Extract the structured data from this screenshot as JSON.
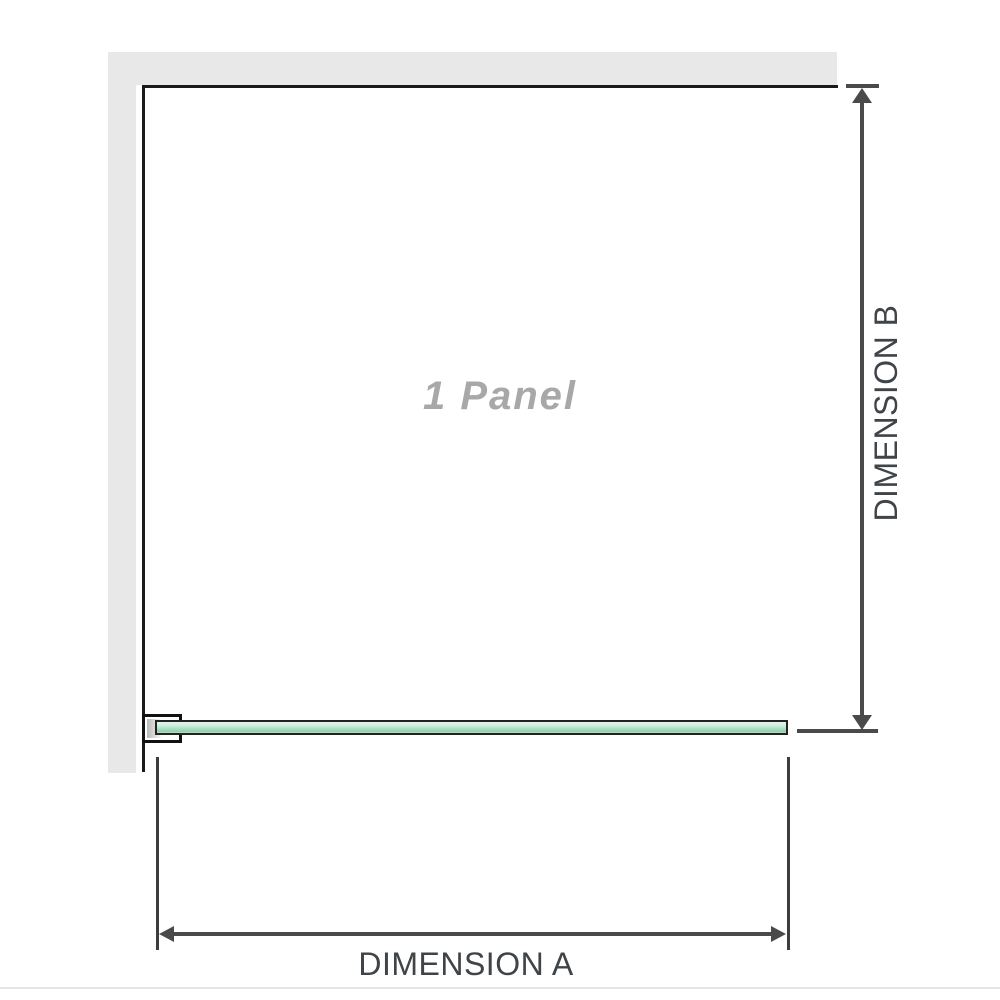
{
  "diagram": {
    "panel_label": "1 Panel",
    "dimension_a": {
      "label": "DIMENSION A"
    },
    "dimension_b": {
      "label": "DIMENSION B"
    },
    "colors": {
      "wall": "#e8e8e8",
      "panel_border": "#1a1a1a",
      "bracket_border": "#111111",
      "glass_border": "#222222",
      "glass_fill_light": "#e4f5ec",
      "glass_fill_mid": "#a8dcc0",
      "glass_fill_dark": "#8fd0ab",
      "dimension_line": "#4a4a4a",
      "extension_line": "#3d3d3d",
      "label_text": "#3f4449",
      "panel_label_text": "#a8a8a8",
      "baseline_rule": "#e5e5e2"
    }
  }
}
